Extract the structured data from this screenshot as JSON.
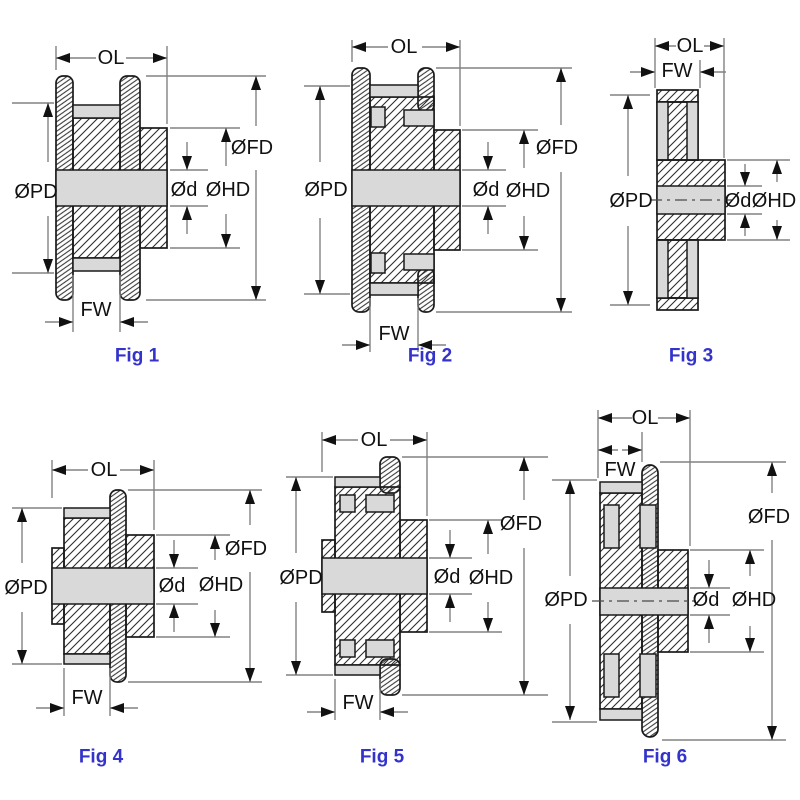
{
  "diagram": {
    "dimension_labels": {
      "ol": "OL",
      "fw": "FW",
      "pd": "ØPD",
      "fd": "ØFD",
      "hd": "ØHD",
      "d": "Ød"
    },
    "figures": [
      {
        "caption": "Fig 1"
      },
      {
        "caption": "Fig 2"
      },
      {
        "caption": "Fig 3"
      },
      {
        "caption": "Fig 4"
      },
      {
        "caption": "Fig 5"
      },
      {
        "caption": "Fig 6"
      }
    ],
    "colors": {
      "caption_blue": "#3333CC",
      "outline": "#1a1a1a",
      "dimension_line": "#828282",
      "section_fill": "#d9d9d9",
      "background": "#ffffff"
    }
  }
}
